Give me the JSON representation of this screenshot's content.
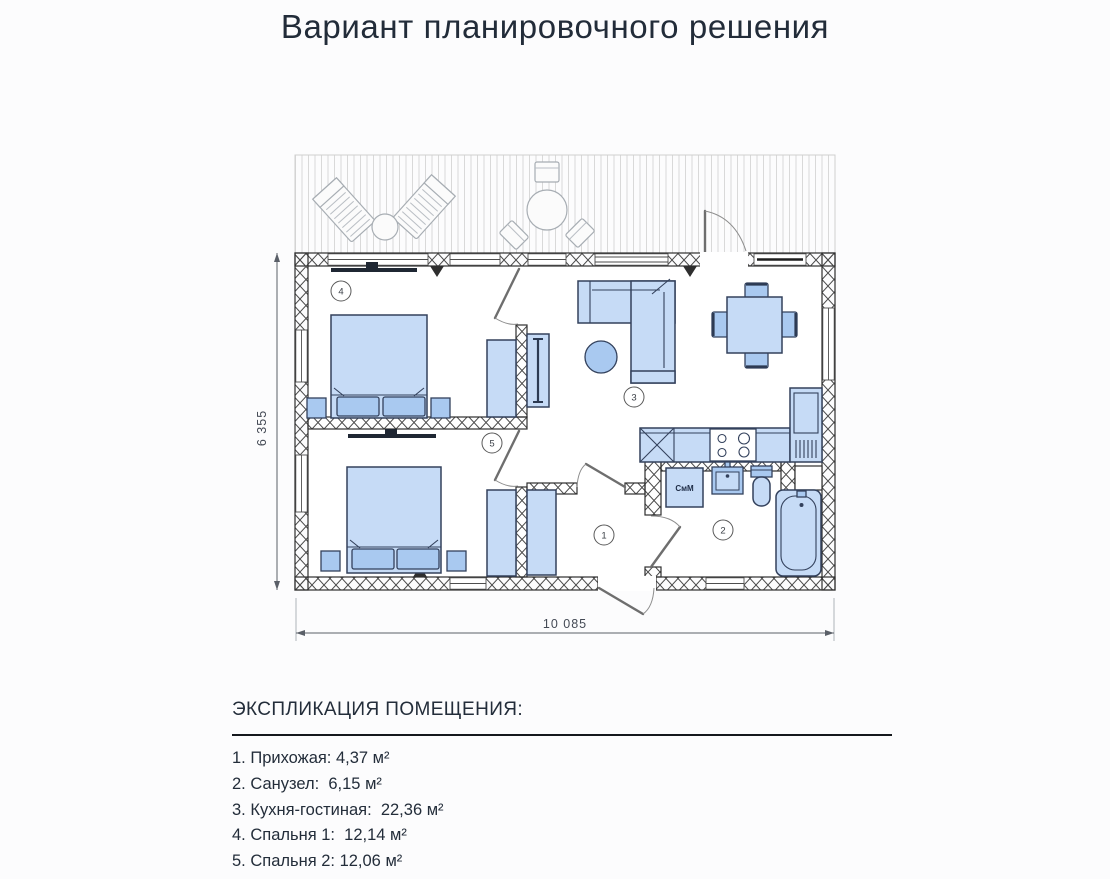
{
  "title": "Вариант планировочного решения",
  "plan": {
    "dimension_width": "10 085",
    "dimension_height": "6 355",
    "washing_machine_label": "СмМ",
    "room_markers": {
      "hallway": "1",
      "bathroom": "2",
      "kitchen_living": "3",
      "bedroom_1": "4",
      "bedroom_2": "5"
    },
    "colors": {
      "furniture_fill": "#c6dbf6",
      "furniture_fill_dark": "#a9c9f0",
      "furniture_stroke": "#33415c",
      "wall_line": "#2e2e2e",
      "terrace_line": "#d9d9d9",
      "text": "#232d3a"
    }
  },
  "explication": {
    "heading": "ЭКСПЛИКАЦИЯ ПОМЕЩЕНИЯ:",
    "items": [
      "1. Прихожая: 4,37 м²",
      "2. Санузел:  6,15 м²",
      "3. Кухня-гостиная:  22,36 м²",
      "4. Спальня 1:  12,14 м²",
      "5. Спальня 2: 12,06 м²"
    ]
  }
}
